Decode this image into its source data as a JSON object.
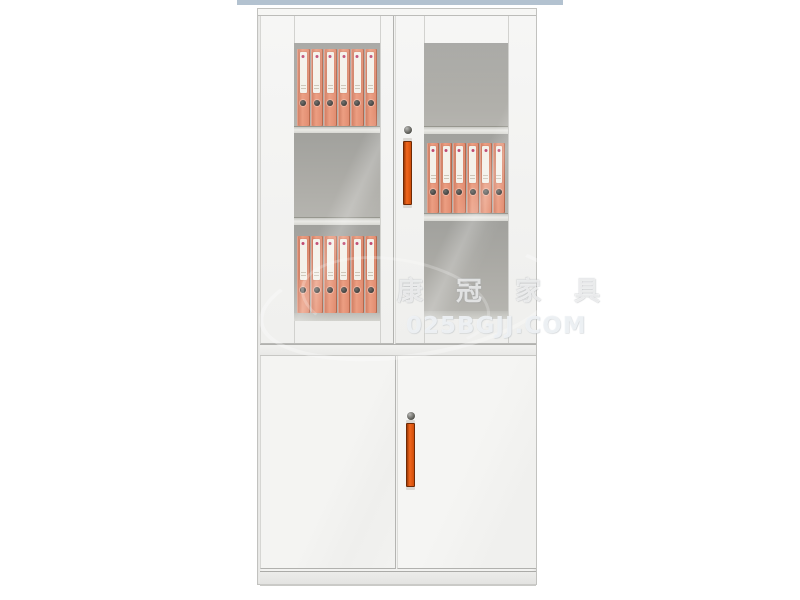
{
  "scene": {
    "type": "furniture-product-photo",
    "subject": "white steel office filing cabinet with upper glass doors and lower solid doors",
    "background": "#ffffff"
  },
  "top_strip": {
    "color": "#b3c2d0"
  },
  "watermark": {
    "brand_text": "康 冠 家 具",
    "domain_text": "025BGJJ.COM"
  },
  "cabinet": {
    "colors": {
      "body_white": "#f2f2f0",
      "frame_line": "#c2c2bf",
      "glass_interior": "#a7a7a3",
      "shelf": "#d8d8d3",
      "binder_orange": "#ec9e82",
      "binder_label": "#f4f1ea",
      "handle_orange": "#f2661c",
      "lock_gray": "#55554f",
      "strip_blue": "#b3c2d0"
    },
    "upper": {
      "left_door": {
        "compartments": [
          {
            "binder_count": 6
          },
          {
            "binder_count": 0
          },
          {
            "binder_count": 6
          }
        ]
      },
      "right_door": {
        "lock": "keyhole",
        "handle": "vertical-orange-bar",
        "compartments": [
          {
            "binder_count": 0
          },
          {
            "binder_count": 6
          },
          {
            "binder_count": 0
          }
        ]
      }
    },
    "lower": {
      "left_door": {},
      "right_door": {
        "lock": "keyhole",
        "handle": "vertical-orange-bar"
      }
    }
  }
}
